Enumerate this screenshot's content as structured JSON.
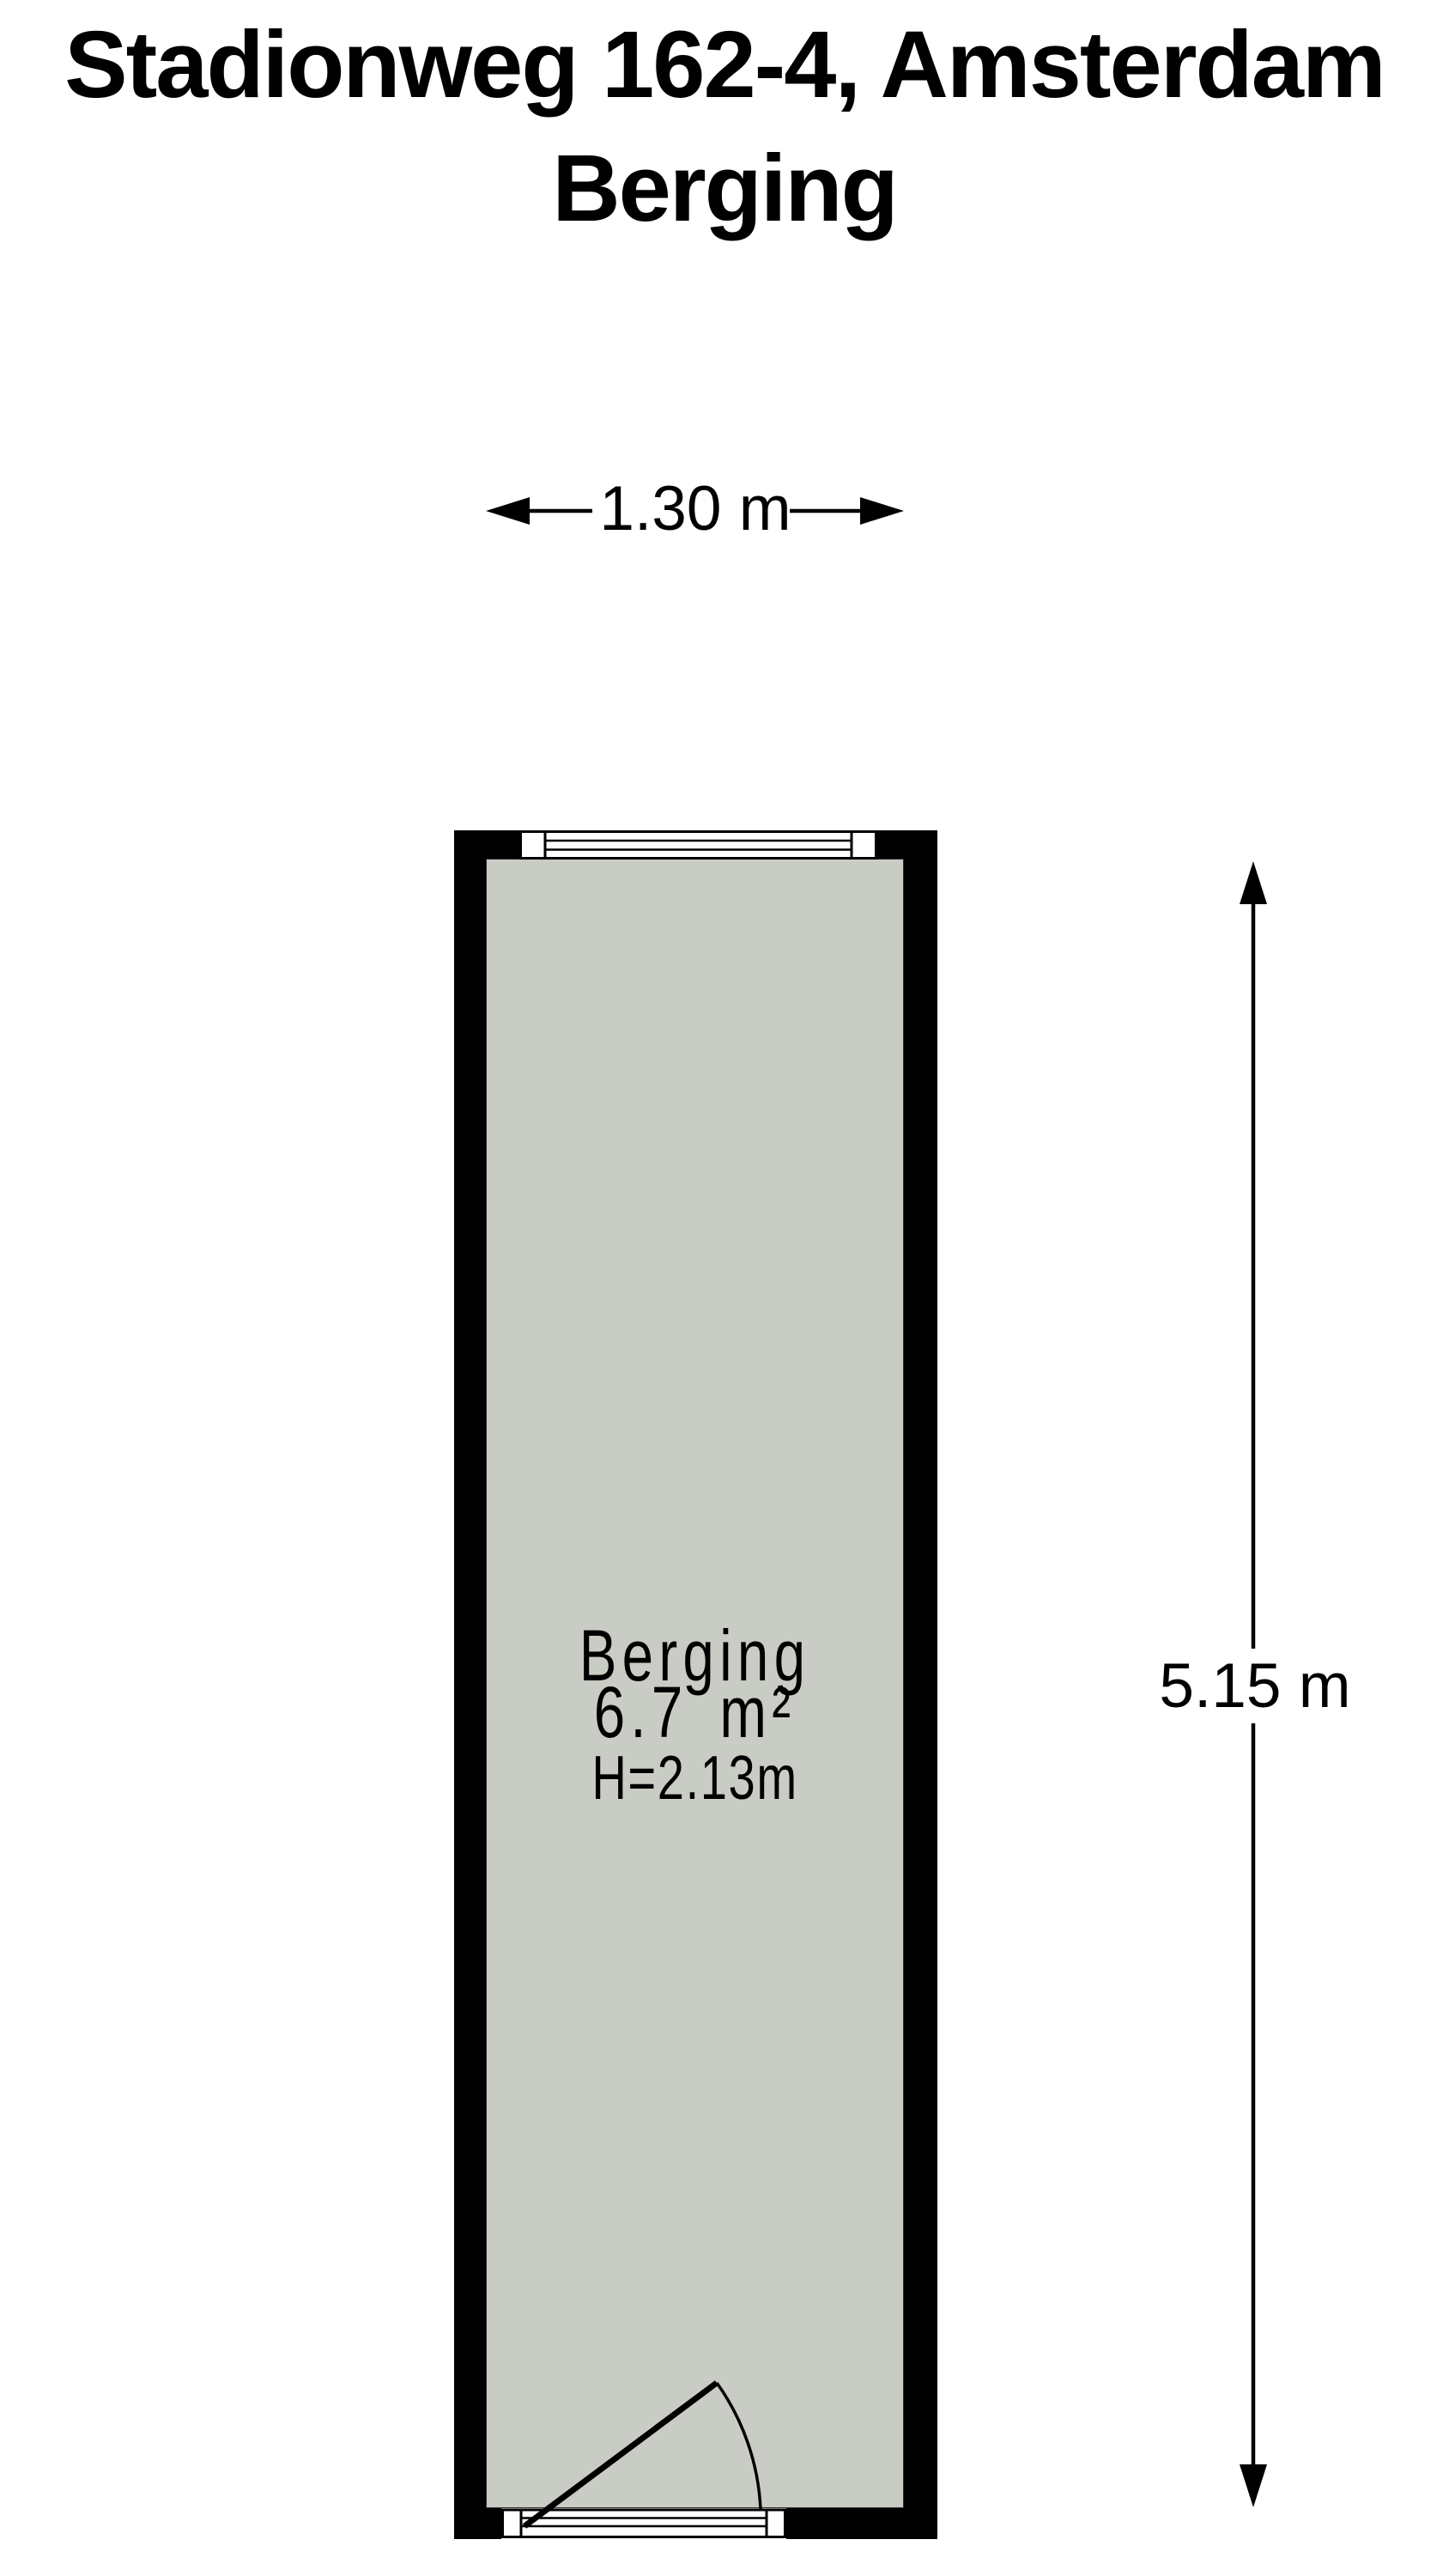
{
  "title": {
    "line1": "Stadionweg 162-4, Amsterdam",
    "line2": "Berging"
  },
  "dimensions": {
    "width": "1.30 m",
    "height": "5.15 m"
  },
  "room": {
    "name": "Berging",
    "area": "6.7 m²",
    "ceiling_height": "H=2.13m"
  },
  "colors": {
    "background": "#ffffff",
    "wall": "#000000",
    "floor": "#c9ccc4",
    "line": "#000000"
  }
}
